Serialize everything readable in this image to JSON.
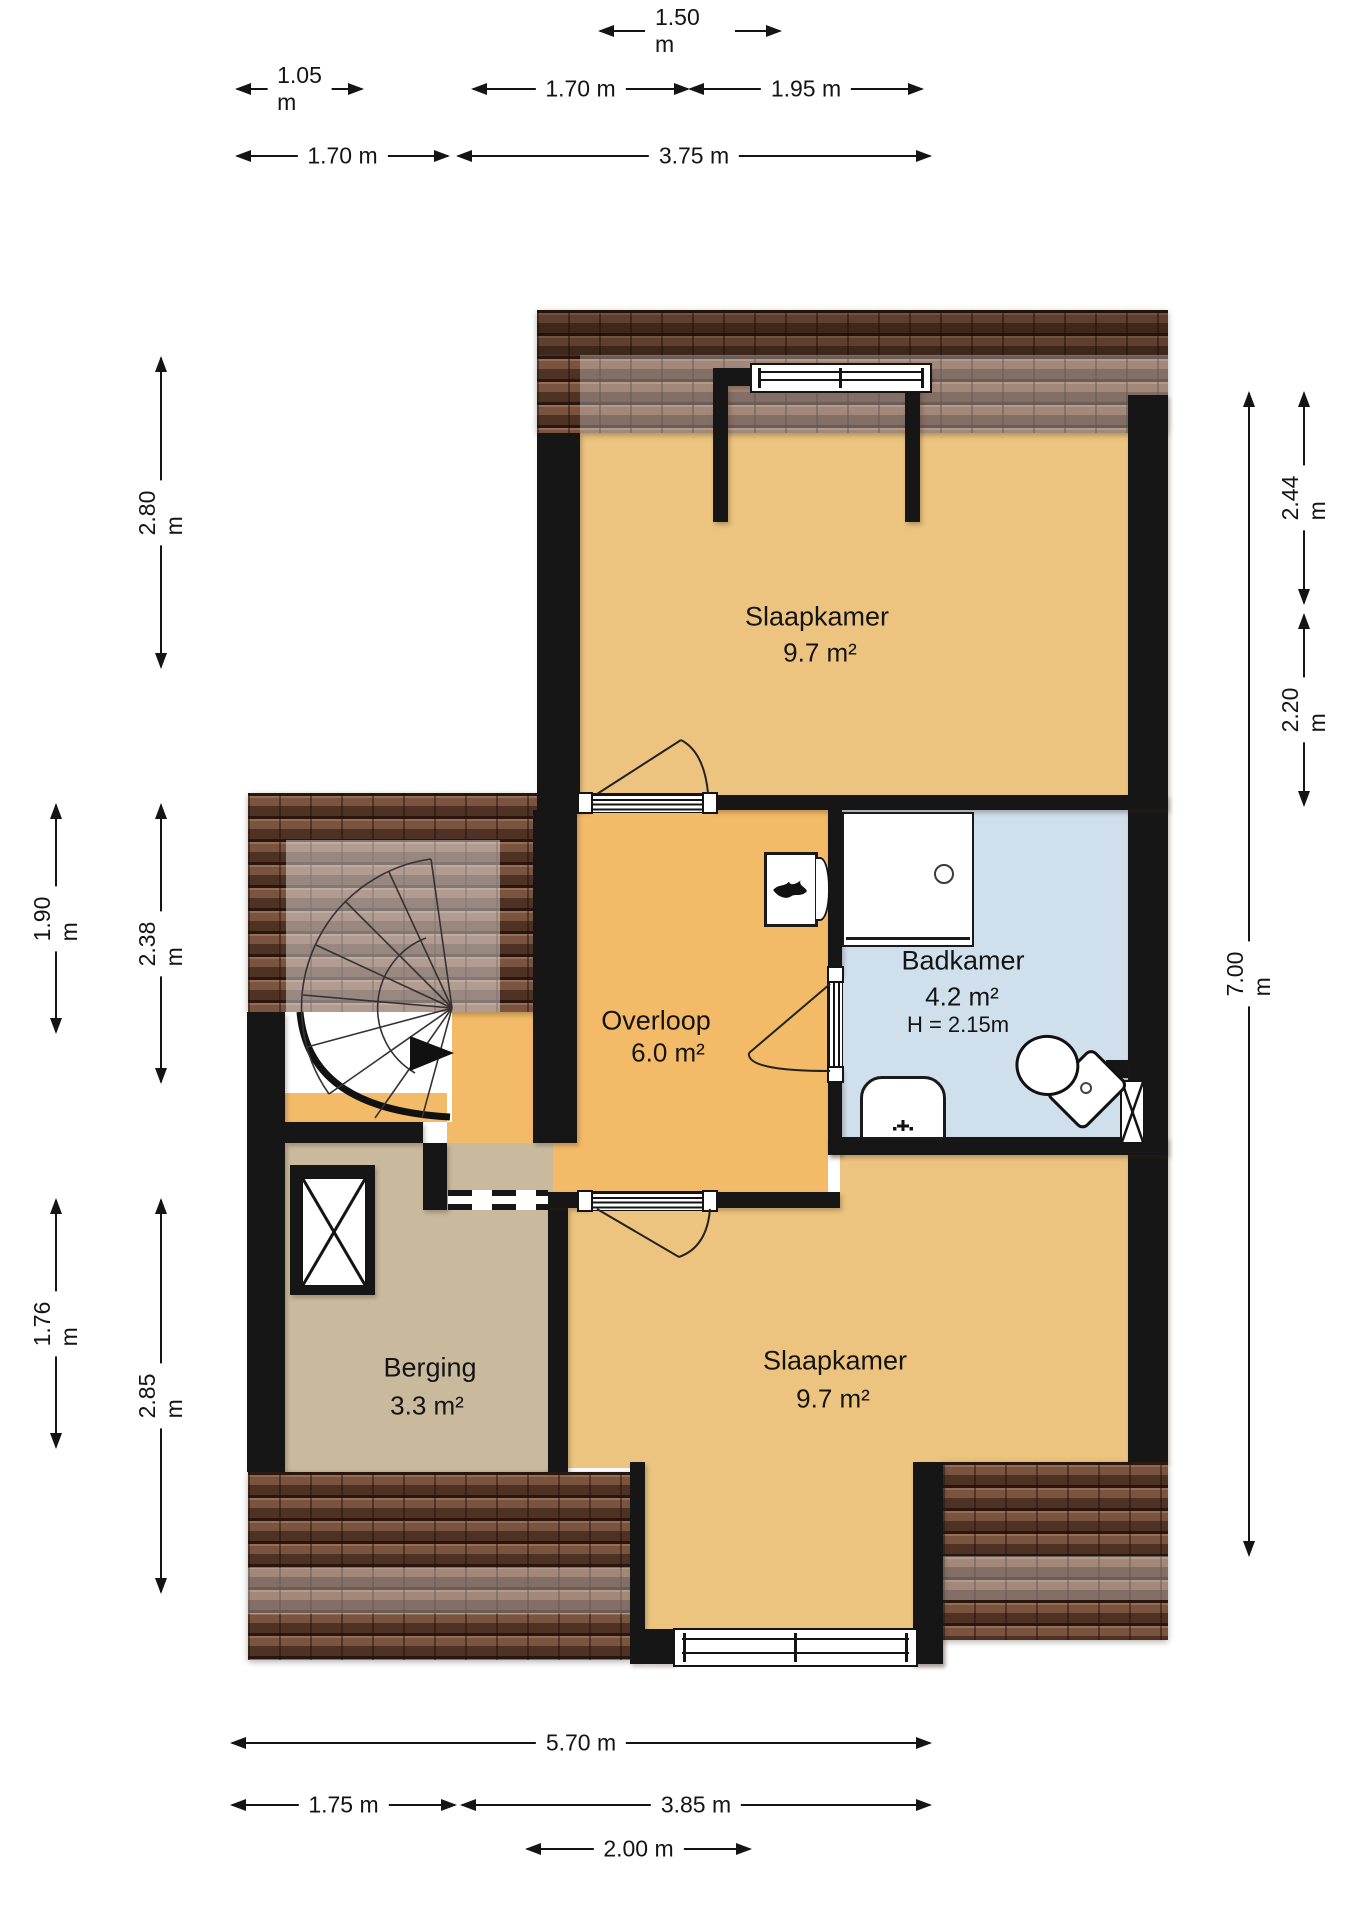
{
  "rooms": {
    "slaapkamer_top": {
      "name": "Slaapkamer",
      "area": "9.7 m²"
    },
    "overloop": {
      "name": "Overloop",
      "area": "6.0 m²"
    },
    "badkamer": {
      "name": "Badkamer",
      "area": "4.2  m²",
      "ceiling_height": "H = 2.15m"
    },
    "berging": {
      "name": "Berging",
      "area": "3.3 m²"
    },
    "slaapkamer_bottom": {
      "name": "Slaapkamer",
      "area": "9.7 m²"
    }
  },
  "dims": {
    "t_150": "1.50 m",
    "t_105": "1.05 m",
    "t_170a": "1.70 m",
    "t_195": "1.95 m",
    "t_170b": "1.70 m",
    "t_375": "3.75 m",
    "l_280": "2.80 m",
    "l_190": "1.90 m",
    "l_238": "2.38 m",
    "l_176": "1.76 m",
    "l_285": "2.85 m",
    "r_700": "7.00 m",
    "r_244": "2.44 m",
    "r_220": "2.20 m",
    "b_570": "5.70 m",
    "b_175": "1.75 m",
    "b_385": "3.85 m",
    "b_200": "2.00 m"
  },
  "colors": {
    "wall": "#161616",
    "bedroom_fill": "#ECC480",
    "overloop_fill": "#F3BA68",
    "bathroom_fill": "#CFDFEC",
    "storage_fill": "#C9BA9D",
    "roof_base": "#7B5440",
    "roof_dark": "#2A160E"
  },
  "icons": {
    "flame": "flame-icon",
    "drain": "shower-drain-icon",
    "tap": "sink-tap-icon",
    "duct": "x-hatch-duct",
    "shaft": "x-hatch-shaft",
    "stair_arrow": "stair-direction-arrow"
  }
}
